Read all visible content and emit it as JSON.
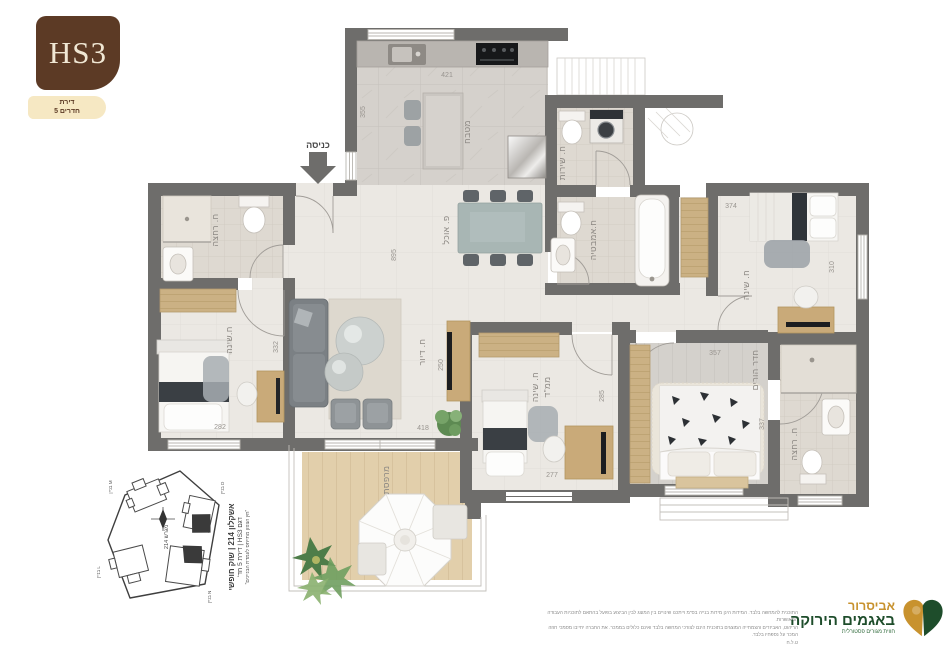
{
  "header": {
    "model": "HS3",
    "badge": {
      "line1": "דירת",
      "line2": "5 חדרים"
    }
  },
  "plan": {
    "entrance": "כניסה",
    "rooms": {
      "kitchen": "מטבח",
      "dining": "פ. אוכל",
      "living": "ח. דיור",
      "shower_left": "ח. רחצה",
      "bedroom_left": "ח.שינה",
      "service": "ח. שירות",
      "bathroom": "ח.אמבטיה",
      "bedroom_right": "ח. שינה",
      "mamad_line1": "ח. שינה",
      "mamad_line2": "ממ\"ד",
      "master": "חדר הורים",
      "ensuite": "ח. רחצה",
      "balcony": "מרפסת"
    },
    "dims": {
      "kitchen_w": "421",
      "kitchen_h": "355",
      "hall_h": "895",
      "living_h": "250",
      "living_w": "418",
      "bed_left_h": "332",
      "bed_left_w": "282",
      "bed_right_w": "374",
      "bed_right_h": "310",
      "mamad_h": "285",
      "mamad_w": "277",
      "master_w": "357",
      "master_h": "337"
    }
  },
  "siteplan": {
    "lot": "מגרש 214",
    "building_m": "בניין M",
    "building_d": "בניין D",
    "building_l": "בניין L",
    "building_n": "בניין N",
    "caption": {
      "line1": "אשקלון 214 | שוק חופשי",
      "line2": "דגם HS3 | דירת 5 חד'",
      "line3": "\"חץ הצפון מתייחס לעמדת הבניינים\""
    }
  },
  "footer": {
    "disclaimer": {
      "line1": "התוכנית להמחשה בלבד. המידות הינן מידות בנייה בס\"מ וייתכנו שינויים בין המוצג לבין הביצוע בפועל בהתאם לתוכניות העבודה המאושרות.",
      "line2": "הריהוט, האביזרים והצמחייה המוצגים בתוכנית הינם לצורכי המחשה בלבד ואינם כלולים בממכר. את החברה יחייבו מסמכי חוזה המכר על נספחיו בלבד.",
      "line3": "ט.ל.ח"
    },
    "brand": {
      "line1": "אביסרור",
      "line2": "באגמים הירוקה",
      "line3": "חווית מגורים פסטורלית"
    }
  },
  "colors": {
    "wall": "#6e6d6b",
    "brand_gold": "#c8922e",
    "brand_green": "#1e4d2b",
    "hs3_brown": "#5c3a25",
    "badge_bg": "#f6e8c3"
  }
}
